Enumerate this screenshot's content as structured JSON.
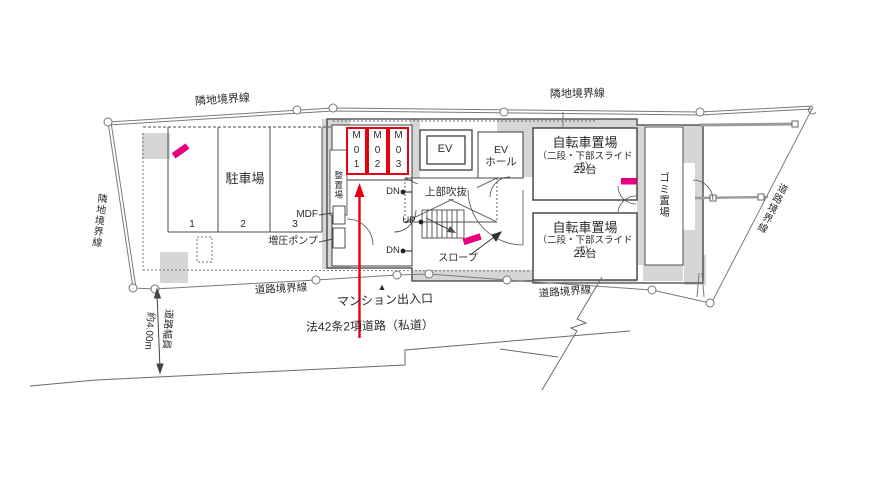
{
  "colors": {
    "line": "#6b6b6b",
    "building": "#3f3f3f",
    "wall_fill": "#d6d6d6",
    "red": "#e60012",
    "pink": "#e4007f"
  },
  "boundaries": {
    "adjacent_top_left": "隣地境界線",
    "adjacent_top_right": "隣地境界線",
    "adjacent_left": "隣地境界線",
    "road_bottom_left": "道路境界線",
    "road_bottom_right": "道路境界線",
    "road_right": "道路境界線"
  },
  "parking": {
    "label": "駐車場",
    "stalls": [
      "1",
      "2",
      "3"
    ]
  },
  "equipment": {
    "mdf": "MDF",
    "pump": "増圧ポンプ",
    "storage": "整置場"
  },
  "bike_spaces": {
    "m01": "M\n0\n1",
    "m02": "M\n0\n2",
    "m03": "M\n0\n3"
  },
  "elevator": {
    "ev": "EV",
    "hall": "EV\nホール"
  },
  "stairs": {
    "dn_top": "DN",
    "up": "UP",
    "dn_bottom": "DN",
    "void": "上部吹抜",
    "slope": "スロープ"
  },
  "bicycle": {
    "title": "自転車置場",
    "subtitle": "（二段・下部スライド式）",
    "count": "22台"
  },
  "garbage": {
    "label": "ゴミ置場"
  },
  "road": {
    "entrance_marker": "▲",
    "entrance": "マンション出入口",
    "road_type": "法42条2項道路（私道）",
    "width_label": "道路幅員",
    "width_value": "約4.00m"
  }
}
